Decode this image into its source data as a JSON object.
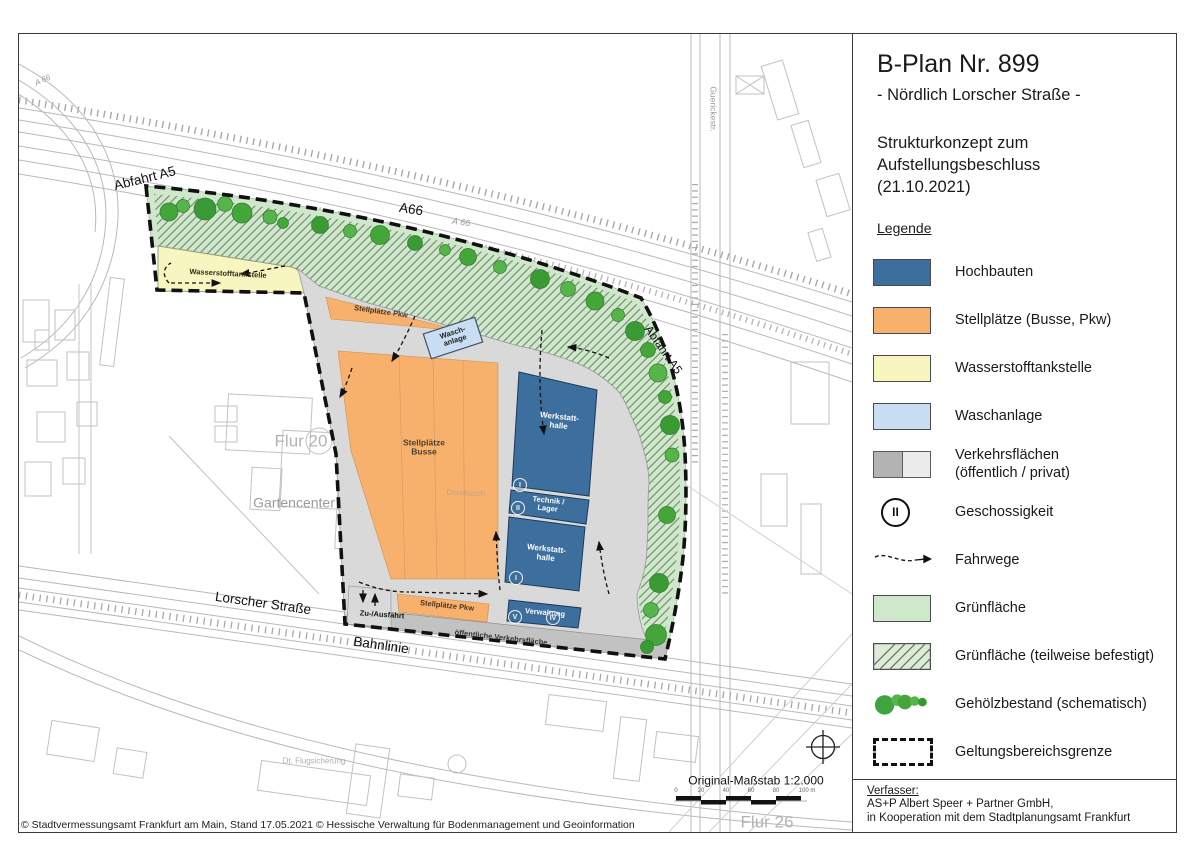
{
  "panel": {
    "title": "B-Plan Nr. 899",
    "subtitle": "- Nördlich Lorscher Straße -",
    "concept": "Strukturkonzept zum\nAufstellungsbeschluss\n(21.10.2021)",
    "legend_heading": "Legende",
    "geschoss_symbol": "II",
    "legend_items": [
      "Hochbauten",
      "Stellplätze (Busse, Pkw)",
      "Wasserstofftankstelle",
      "Waschanlage",
      "Verkehrsflächen\n(öffentlich / privat)",
      "Geschossigkeit",
      "Fahrwege",
      "Grünfläche",
      "Grünfläche (teilweise befestigt)",
      "Gehölzbestand (schematisch)",
      "Geltungsbereichsgrenze"
    ],
    "verfasser_heading": "Verfasser:",
    "verfasser_line1": "AS+P Albert Speer + Partner GmbH,",
    "verfasser_line2": "in Kooperation mit dem Stadtplanungsamt Frankfurt"
  },
  "map": {
    "labels": {
      "abfahrt_a5_left": "Abfahrt A5",
      "a66": "A66",
      "a66_small_right": "A 66",
      "a66_small_topleft": "A 66",
      "abfahrt_a5_right": "Abfahrt A5",
      "guerickestr": "Guerickestr.",
      "wasserstofftankstelle": "Wasserstofftankstelle",
      "stellplaetze_pkw_top": "Stellplätze Pkw",
      "waschanlage": "Wasch-\nanlage",
      "stellplaetze_busse": "Stellplätze\nBusse",
      "dornbusch": "Dornbusch",
      "werkstatthalle_1": "Werkstatt-\nhalle",
      "technik_lager": "Technik /\nLager",
      "werkstatthalle_2": "Werkstatt-\nhalle",
      "verwaltung": "Verwaltung",
      "stellplaetze_pkw_bottom": "Stellplätze Pkw",
      "zu_ausfahrt": "Zu-/Ausfahrt",
      "oeffentliche_verkehrsflaeche": "öffentliche Verkehrsfläche",
      "lorscher_strasse": "Lorscher Straße",
      "bahnlinie": "Bahnlinie",
      "flur_20": "Flur 20",
      "flur_26": "Flur 26",
      "gartencenter": "Gartencenter",
      "dt_flugsicherung": "Dt. Flugsicherung"
    },
    "geschoss_marks": [
      "I",
      "II",
      "I",
      "V",
      "IV"
    ],
    "scale": {
      "label": "Original-Maßstab 1:2.000",
      "ticks": [
        "0",
        "20",
        "40",
        "60",
        "80",
        "100 m"
      ]
    },
    "copyright": "© Stadtvermessungsamt Frankfurt am Main, Stand 17.05.2021 © Hessische Verwaltung für Bodenmanagement und Geoinformation"
  },
  "colors": {
    "hochbauten": "#3d6f9e",
    "stellplaetze": "#f8b16d",
    "wasserstofftankstelle": "#f8f6c0",
    "waschanlage": "#c9def2",
    "verkehr_oeffentlich": "#b3b3b3",
    "verkehr_privat": "#ececec",
    "gruenflaeche": "#cfe7cb",
    "hatch": "#5c7257",
    "gehoelz": "#3fa33f",
    "grenze": "#111111"
  }
}
